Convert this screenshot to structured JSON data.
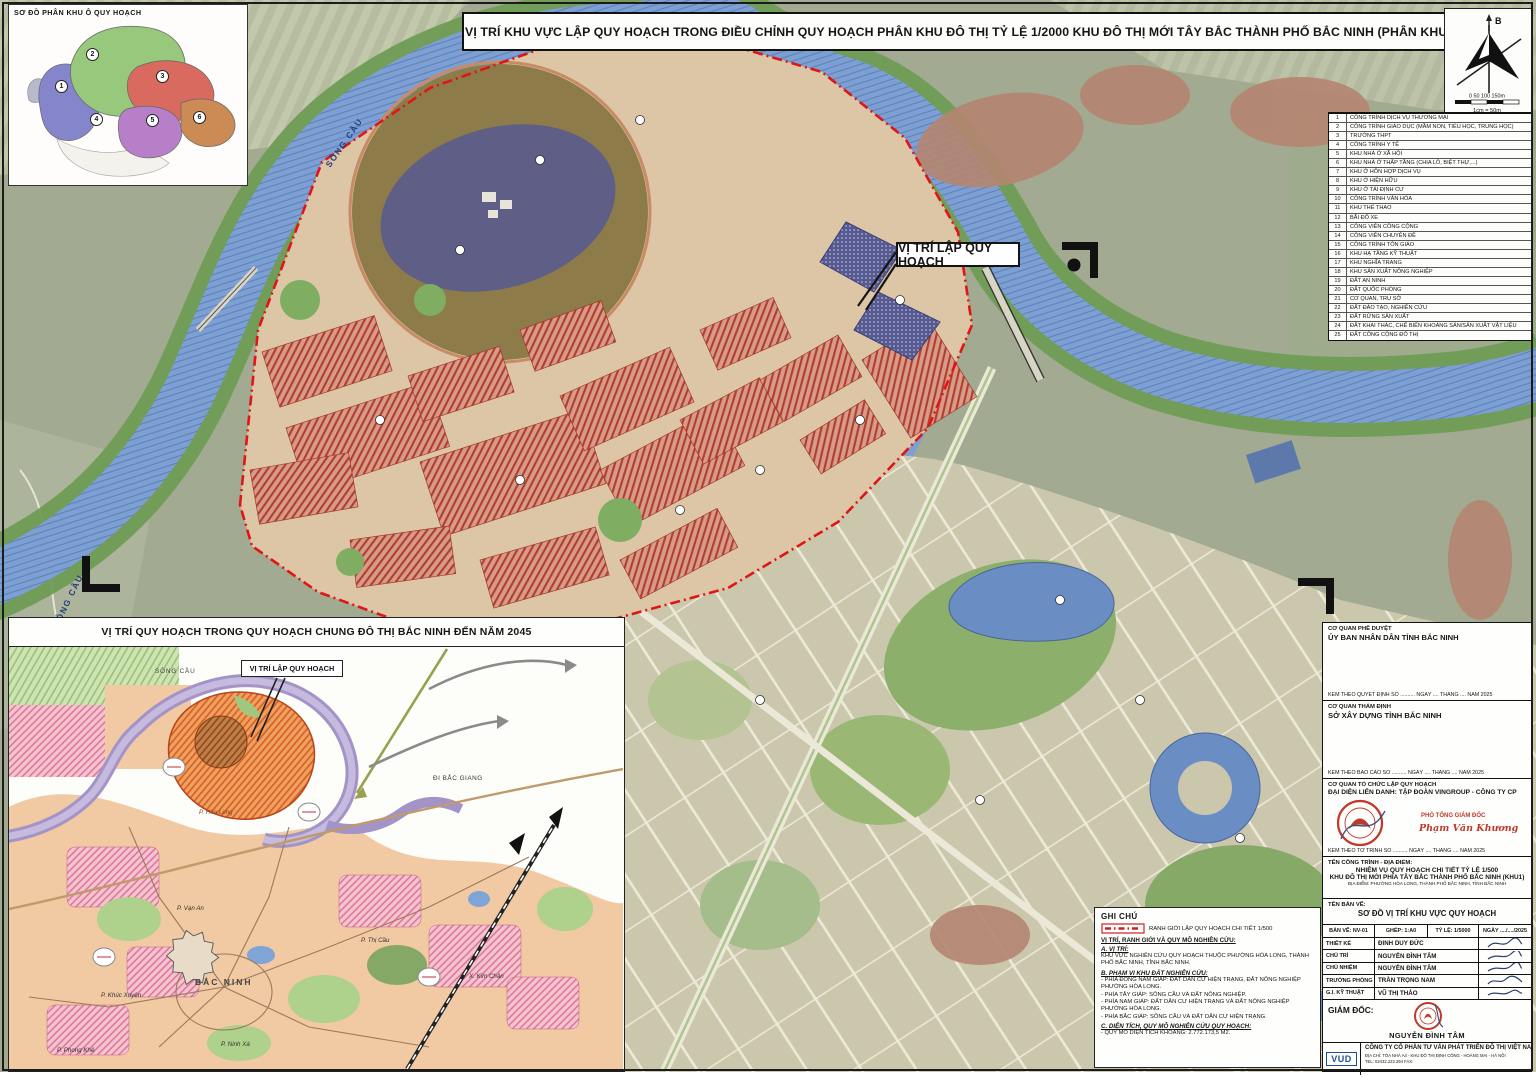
{
  "header": {
    "title": "VỊ TRÍ KHU VỰC LẬP QUY HOẠCH TRONG ĐIỀU CHỈNH QUY HOẠCH PHÂN KHU ĐÔ THỊ TỶ LỆ  1/2000 KHU ĐÔ THỊ MỚI TÂY BẮC THÀNH PHỐ BẮC NINH (PHÂN KHU 14)"
  },
  "inset_top_left": {
    "title": "SƠ ĐỒ PHÂN KHU Ô QUY HOẠCH",
    "zones": [
      {
        "num": "1"
      },
      {
        "num": "2"
      },
      {
        "num": "3"
      },
      {
        "num": "4"
      },
      {
        "num": "5"
      },
      {
        "num": "6"
      }
    ]
  },
  "compass": {
    "north_label": "B",
    "scale_ticks": "0    50   100  150m",
    "scale_note": "1cm = 50m"
  },
  "legend": {
    "items": [
      {
        "num": "1",
        "label": "CÔNG TRÌNH DỊCH VỤ THƯƠNG MẠI"
      },
      {
        "num": "2",
        "label": "CÔNG TRÌNH GIÁO DỤC (MẦM NON, TIỂU HỌC, TRUNG HỌC)"
      },
      {
        "num": "3",
        "label": "TRƯỜNG THPT"
      },
      {
        "num": "4",
        "label": "CÔNG TRÌNH Y TẾ"
      },
      {
        "num": "5",
        "label": "KHU NHÀ Ở XÃ HỘI"
      },
      {
        "num": "6",
        "label": "KHU NHÀ Ở THẤP TẦNG (CHIA LÔ, BIỆT THỰ,...)"
      },
      {
        "num": "7",
        "label": "KHU Ở HỖN HỢP DỊCH VỤ"
      },
      {
        "num": "8",
        "label": "KHU Ở HIỆN HỮU"
      },
      {
        "num": "9",
        "label": "KHU Ở TÁI ĐỊNH CƯ"
      },
      {
        "num": "10",
        "label": "CÔNG TRÌNH VĂN HÓA"
      },
      {
        "num": "11",
        "label": "KHU THỂ THAO"
      },
      {
        "num": "12",
        "label": "BÃI ĐỖ XE"
      },
      {
        "num": "13",
        "label": "CÔNG VIÊN CÔNG CỘNG"
      },
      {
        "num": "14",
        "label": "CÔNG VIÊN CHUYÊN ĐỀ"
      },
      {
        "num": "15",
        "label": "CÔNG TRÌNH TÔN GIÁO"
      },
      {
        "num": "16",
        "label": "KHU HẠ TẦNG KỸ THUẬT"
      },
      {
        "num": "17",
        "label": "KHU NGHĨA TRANG"
      },
      {
        "num": "18",
        "label": "KHU SẢN XUẤT NÔNG NGHIỆP"
      },
      {
        "num": "19",
        "label": "ĐẤT AN NINH"
      },
      {
        "num": "20",
        "label": "ĐẤT QUỐC PHÒNG"
      },
      {
        "num": "21",
        "label": "CƠ QUAN, TRỤ SỞ"
      },
      {
        "num": "22",
        "label": "ĐẤT ĐÀO TẠO, NGHIÊN CỨU"
      },
      {
        "num": "23",
        "label": "ĐẤT RỪNG SẢN XUẤT"
      },
      {
        "num": "24",
        "label": "ĐẤT KHAI THÁC, CHẾ BIẾN KHOÁNG SẢN/SẢN XUẤT VẬT LIỆU"
      },
      {
        "num": "25",
        "label": "ĐẤT CÔNG CỘNG ĐÔ THỊ"
      }
    ]
  },
  "map": {
    "callout": "VỊ TRÍ LẬP QUY HOẠCH",
    "river_label_1": "SÔNG CẦU",
    "river_label_2": "SÔNG CẦU"
  },
  "inset_bottom_left": {
    "title": "VỊ TRÍ QUY HOẠCH TRONG QUY HOẠCH CHUNG ĐÔ THỊ BẮC NINH ĐẾN NĂM 2045",
    "river_label": "SÔNG CẦU",
    "callout": "VỊ TRÍ LẬP QUY HOẠCH",
    "direction_label": "ĐI BẮC GIANG",
    "city_label": "BẮC NINH",
    "wards": [
      {
        "text": "P. Hòa Long"
      },
      {
        "text": "P. Vạn An"
      },
      {
        "text": "P. Khúc Xuyên"
      },
      {
        "text": "P. Phong Khê"
      },
      {
        "text": "P. Ninh Xá"
      },
      {
        "text": "P. Thị Cầu"
      },
      {
        "text": "X. Kim Chân"
      }
    ]
  },
  "notes": {
    "title": "GHI CHÚ",
    "boundary_label": "RANH GIỚI LẬP QUY HOẠCH CHI TIẾT 1/500",
    "heading": "VỊ TRÍ, RANH GIỚI VÀ QUY MÔ NGHIÊN CỨU:",
    "a_title": "A. VỊ TRÍ:",
    "a_text": "KHU VỰC NGHIÊN CỨU QUY HOẠCH THUỘC PHƯỜNG HÒA LONG, THÀNH PHỐ BẮC NINH, TỈNH BẮC NINH.",
    "b_title": "B. PHẠM VI KHU ĐẤT NGHIÊN CỨU:",
    "b_items": [
      {
        "text": "-  PHÍA ĐÔNG NAM GIÁP: ĐẤT DÂN CƯ HIỆN TRẠNG, ĐẤT NÔNG NGHIỆP PHƯỜNG HÒA LONG."
      },
      {
        "text": "-  PHÍA TÂY GIÁP: SÔNG CẦU VÀ ĐẤT NÔNG NGHIỆP."
      },
      {
        "text": "-  PHÍA NAM GIÁP: ĐẤT DÂN CƯ HIỆN TRẠNG VÀ ĐẤT NÔNG NGHIỆP PHƯỜNG HÒA LONG."
      },
      {
        "text": "-  PHÍA BẮC GIÁP: SÔNG CẦU VÀ ĐẤT DÂN CƯ HIỆN TRẠNG."
      }
    ],
    "c_title": "C. DIỆN TÍCH, QUY MÔ NGHIÊN CỨU QUY HOẠCH:",
    "c_text": "- QUY MÔ DIỆN TÍCH KHOẢNG: 2.772.173,5 M2."
  },
  "title_block": {
    "approve_label": "CƠ QUAN PHÊ DUYỆT",
    "approve_name": "ỦY BAN NHÂN DÂN TỈNH BẮC NINH",
    "approve_footer": "KÈM THEO QUYẾT ĐỊNH SỐ .......... NGÀY .... THÁNG .... NĂM 2025",
    "review_label": "CƠ QUAN THẨM ĐỊNH",
    "review_name": "SỞ XÂY DỰNG TỈNH BẮC NINH",
    "review_footer": "KÈM THEO BÁO CÁO SỐ .......... NGÀY .... THÁNG .... NĂM 2025",
    "org_label": "CƠ QUAN TỔ CHỨC LẬP QUY HOẠCH",
    "org_name": "ĐẠI DIỆN LIÊN DANH: TẬP ĐOÀN VINGROUP - CÔNG TY CP",
    "org_role": "PHÓ TỔNG GIÁM ĐỐC",
    "org_signer": "Phạm Văn Khương",
    "org_footer": "KÈM THEO TỜ TRÌNH SỐ .......... NGÀY .... THÁNG .... NĂM 2025",
    "project_label": "TÊN CÔNG TRÌNH - ĐỊA ĐIỂM:",
    "project_line1": "NHIỆM VỤ QUY HOẠCH CHI TIẾT TỶ LỆ 1/500",
    "project_line2": "KHU ĐÔ THỊ MỚI PHÍA TÂY BẮC THÀNH PHỐ BẮC NINH (KHU1)",
    "project_line3": "ĐỊA ĐIỂM: PHƯỜNG HÒA LONG, THÀNH PHỐ BẮC NINH, TỈNH BẮC NINH",
    "drawing_label": "TÊN BẢN VẼ:",
    "drawing_name": "SƠ ĐỒ VỊ TRÍ KHU VỰC QUY HOẠCH",
    "meta": [
      {
        "text": "BẢN VẼ: NV-01"
      },
      {
        "text": "GHÉP: 1:A0"
      },
      {
        "text": "TỶ LỆ: 1/5000"
      },
      {
        "text": "NGÀY ..../..../2025"
      }
    ],
    "staff": [
      {
        "role": "THIẾT KẾ",
        "name": "ĐINH DUY ĐỨC"
      },
      {
        "role": "CHỦ TRÌ",
        "name": "NGUYỄN ĐÌNH TÂM"
      },
      {
        "role": "CHỦ NHIỆM",
        "name": "NGUYỄN ĐÌNH TÂM"
      },
      {
        "role": "TRƯỞNG PHÒNG",
        "name": "TRẦN TRỌNG NAM"
      },
      {
        "role": "G.I. KỸ THUẬT",
        "name": "VŨ THỊ THẢO"
      }
    ],
    "director_label": "GIÁM ĐỐC:",
    "director_name": "NGUYỄN ĐÌNH TÂM",
    "company_logo": "VUD",
    "company_name": "CÔNG TY CỔ PHẦN TƯ VẤN PHÁT TRIỂN ĐÔ THỊ VIỆT NAM",
    "company_address": "ĐỊA CHỈ: TÒA NHÀ A4 - KHU ĐÔ THỊ ĐỊNH CÔNG - HOÀNG MAI - HÀ NỘI",
    "company_tel": "TEL: 02432.222.294      FAX:"
  }
}
